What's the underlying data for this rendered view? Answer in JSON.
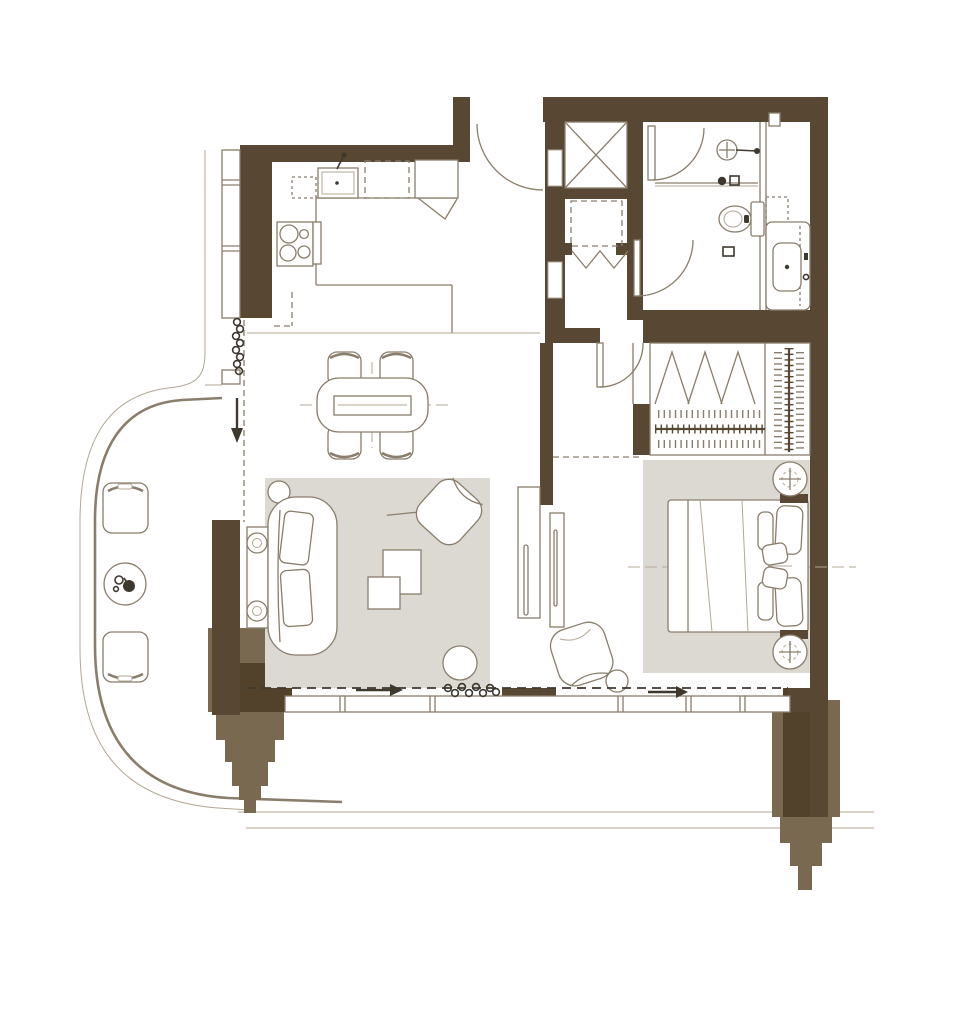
{
  "colors": {
    "wall": "#584733",
    "column": "#7a6951",
    "column-dark": "#52422c",
    "rug": "#dcd9d2",
    "line": "#8a7d6b",
    "line-light": "#b3a794",
    "glyph": "#3e382e",
    "background": "#ffffff"
  },
  "plan": {
    "type": "apartment-floor-plan",
    "text_labels": [],
    "zones": [
      "kitchen",
      "entry-hall",
      "elevator-core",
      "bathroom",
      "living-dining-room",
      "bedroom",
      "wardrobe",
      "balcony"
    ],
    "symbols": [
      "kitchen-sink",
      "cooktop",
      "oven-column",
      "upper-cabinets-dashed",
      "dining-table",
      "dining-chair",
      "sofa",
      "console-table",
      "table-lamp",
      "armchair",
      "coffee-table",
      "ottoman",
      "side-table",
      "tv-console",
      "bed",
      "pillow",
      "nightstand",
      "wardrobe-hanging-rail",
      "bifold-doors",
      "elevator-shaft",
      "appliance-closet",
      "accordion-door",
      "shower-head",
      "glass-partition",
      "toilet",
      "vanity-sink",
      "door-swing",
      "window-band",
      "curtain-coil",
      "slide-arrow",
      "balcony-chair",
      "balcony-table",
      "plant",
      "stepped-facade-column",
      "facade-railing"
    ]
  }
}
